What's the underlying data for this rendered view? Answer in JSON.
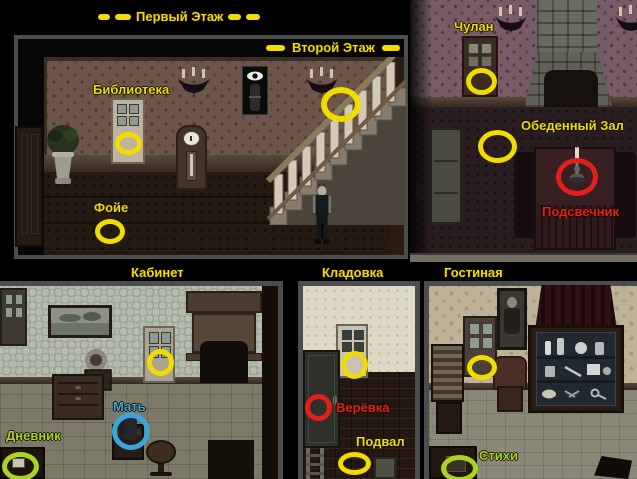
{
  "colors": {
    "marker_yellow": "#f0dc00",
    "marker_red": "#e2201a",
    "marker_green": "#aad41e",
    "marker_blue": "#38a8dc"
  },
  "titles": {
    "first_floor": "Первый Этаж",
    "second_floor": "Второй Этаж"
  },
  "rooms": {
    "library": "Библиотека",
    "foyer": "Фойе",
    "closet": "Чулан",
    "dining_hall": "Обеденный Зал",
    "study": "Кабинет",
    "storage": "Кладовка",
    "living_room": "Гостиная",
    "basement": "Подвал"
  },
  "items": {
    "candlestick": "Подсвечник",
    "rope": "Верёвка",
    "mother": "Мать",
    "diary": "Дневник",
    "poems": "Стихи"
  }
}
